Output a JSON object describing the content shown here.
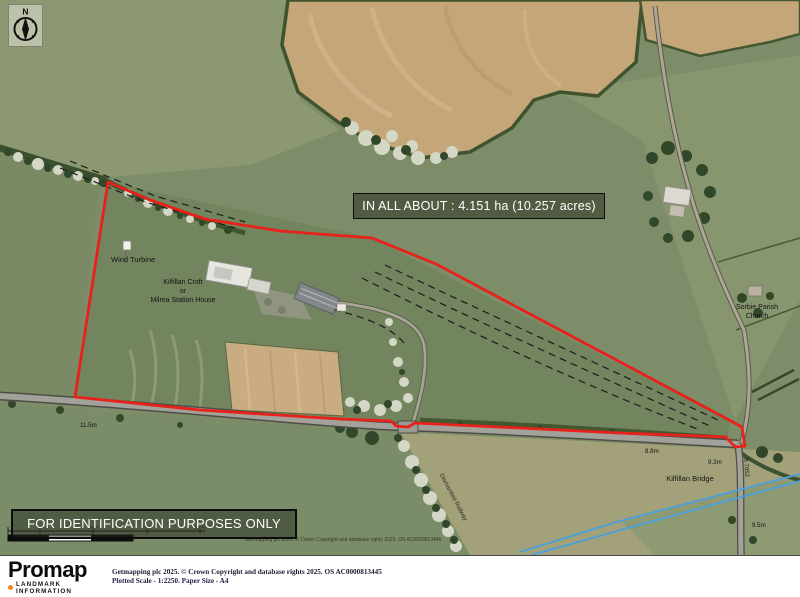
{
  "compass": {
    "letter": "N"
  },
  "area_box": {
    "text": "IN ALL ABOUT : 4.151 ha (10.257 acres)"
  },
  "id_box": {
    "text": "FOR IDENTIFICATION PURPOSES ONLY"
  },
  "map": {
    "labels": {
      "wind_turbine": "Wind Turbine",
      "croft_line1": "Kilfillan Croft",
      "croft_line2": "or",
      "croft_line3": "Milrea Station House",
      "church_line1": "Sorbie Parish",
      "church_line2": "Church",
      "bridge": "Kilfillan Bridge",
      "width_left": "11.5m",
      "width_mid": "8.8m",
      "width_right": "9.3m",
      "width_bottom": "9.5m",
      "road_name": "B 7052",
      "railway": "Dismantled Railway"
    },
    "copyright": "Getmapping plc 2025. © Crown Copyright and database rights 2025. OS AC0000813445"
  },
  "scale_bar": {
    "tick_labels": [
      "50m",
      "100m",
      "150m",
      "200m"
    ]
  },
  "footer": {
    "logo_text": "Promap",
    "logo_subtext": "LANDMARK INFORMATION",
    "credit_line1": "Getmapping plc 2025. © Crown Copyright and database rights 2025. OS AC0000813445",
    "credit_line2": "Plotted Scale - 1:2250. Paper Size - A4"
  },
  "colors": {
    "boundary_red": "#e8211b",
    "stream_blue": "#4aa0dd",
    "landmark_orange": "#f58220"
  }
}
